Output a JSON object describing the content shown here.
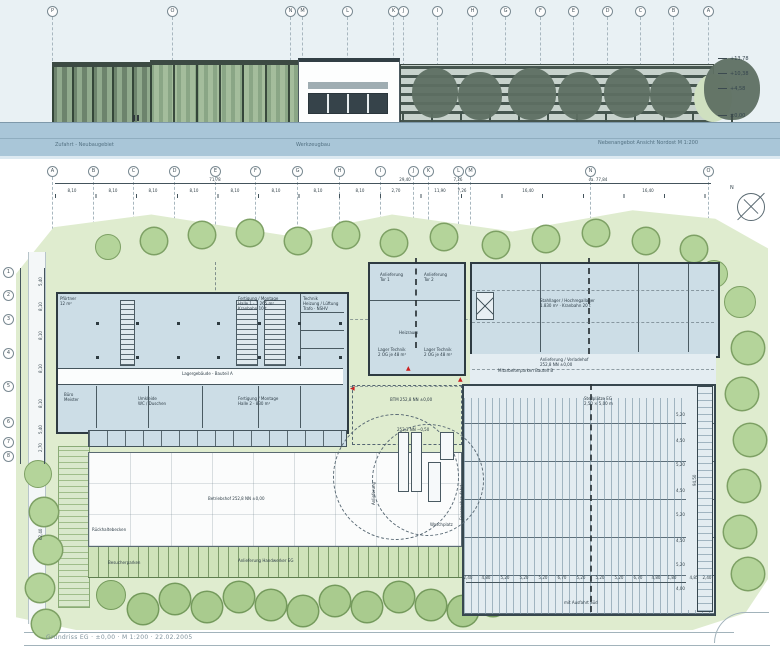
{
  "title_block": {
    "text": "Grundriss EG · ±0,00 · M 1:200 · 22.02.2005"
  },
  "colors": {
    "sky": "#e9f1f4",
    "ground_blue": "#a9c6d8",
    "site_green": "#dfeccf",
    "tree_green": "#b4d49a",
    "building_fill": "#ccdde6",
    "wall": "#2e3b42",
    "red_accent": "#cc2020"
  },
  "elevation": {
    "labels": {
      "left": "Zufahrt - Neubaugebiet",
      "mid": "Werkzeugbau",
      "right": "Nebenangebot Ansicht Nordost M 1:200"
    },
    "levels": [
      {
        "label": "+13,78",
        "x": 718,
        "y": 56
      },
      {
        "label": "+10,38",
        "x": 718,
        "y": 71
      },
      {
        "label": "+4,58",
        "x": 718,
        "y": 86
      },
      {
        "label": "±0,00",
        "x": 718,
        "y": 113
      }
    ],
    "grid_markers": [
      {
        "label": "P",
        "x": 52
      },
      {
        "label": "O",
        "x": 172
      },
      {
        "label": "N",
        "x": 290
      },
      {
        "label": "M",
        "x": 302
      },
      {
        "label": "L",
        "x": 347
      },
      {
        "label": "K",
        "x": 393
      },
      {
        "label": "J",
        "x": 403
      },
      {
        "label": "I",
        "x": 437
      },
      {
        "label": "H",
        "x": 472
      },
      {
        "label": "G",
        "x": 505
      },
      {
        "label": "F",
        "x": 540
      },
      {
        "label": "E",
        "x": 573
      },
      {
        "label": "D",
        "x": 607
      },
      {
        "label": "C",
        "x": 640
      },
      {
        "label": "B",
        "x": 673
      },
      {
        "label": "A",
        "x": 708
      }
    ]
  },
  "plan": {
    "north_label": "N",
    "grid_top": [
      {
        "label": "A",
        "x": 52
      },
      {
        "label": "B",
        "x": 93
      },
      {
        "label": "C",
        "x": 133
      },
      {
        "label": "D",
        "x": 174
      },
      {
        "label": "E",
        "x": 215
      },
      {
        "label": "F",
        "x": 255
      },
      {
        "label": "G",
        "x": 297
      },
      {
        "label": "H",
        "x": 339
      },
      {
        "label": "I",
        "x": 380
      },
      {
        "label": "J",
        "x": 413
      },
      {
        "label": "K",
        "x": 428
      },
      {
        "label": "L",
        "x": 458
      },
      {
        "label": "M",
        "x": 470
      },
      {
        "label": "N",
        "x": 590
      },
      {
        "label": "O",
        "x": 708
      }
    ],
    "grid_left": [
      {
        "label": "1",
        "y": 272
      },
      {
        "label": "2",
        "y": 295
      },
      {
        "label": "3",
        "y": 319
      },
      {
        "label": "4",
        "y": 353
      },
      {
        "label": "5",
        "y": 386
      },
      {
        "label": "6",
        "y": 422
      },
      {
        "label": "7",
        "y": 442
      },
      {
        "label": "8",
        "y": 456
      }
    ],
    "dim_top_upper": [
      {
        "label": "71,78",
        "x": 215
      },
      {
        "label": "29,40",
        "x": 405
      },
      {
        "label": "7,26",
        "x": 458
      },
      {
        "label": "ca. 77,84",
        "x": 598
      }
    ],
    "dim_top_lower": [
      {
        "label": "8,10",
        "x": 72
      },
      {
        "label": "8,10",
        "x": 113
      },
      {
        "label": "8,10",
        "x": 153
      },
      {
        "label": "8,10",
        "x": 194
      },
      {
        "label": "8,10",
        "x": 235
      },
      {
        "label": "8,10",
        "x": 276
      },
      {
        "label": "8,10",
        "x": 318
      },
      {
        "label": "8,10",
        "x": 360
      },
      {
        "label": "2,70",
        "x": 396
      },
      {
        "label": "11,90",
        "x": 440
      },
      {
        "label": "7,26",
        "x": 462
      },
      {
        "label": "16,40",
        "x": 528
      },
      {
        "label": "16,40",
        "x": 648
      }
    ],
    "dim_left_chain": [
      {
        "label": "5,40",
        "y": 286
      },
      {
        "label": "8,10",
        "y": 311
      },
      {
        "label": "8,10",
        "y": 340
      },
      {
        "label": "8,10",
        "y": 373
      },
      {
        "label": "8,10",
        "y": 408
      },
      {
        "label": "5,40",
        "y": 434
      },
      {
        "label": "2,70",
        "y": 452
      },
      {
        "label": "62,40",
        "y": 540
      }
    ],
    "dim_parking_bottom": [
      {
        "label": "2,40",
        "x": 468
      },
      {
        "label": "4,80",
        "x": 486
      },
      {
        "label": "5,20",
        "x": 505
      },
      {
        "label": "5,20",
        "x": 524
      },
      {
        "label": "5,20",
        "x": 543
      },
      {
        "label": "6,70",
        "x": 562
      },
      {
        "label": "5,20",
        "x": 581
      },
      {
        "label": "5,20",
        "x": 600
      },
      {
        "label": "5,20",
        "x": 619
      },
      {
        "label": "6,70",
        "x": 638
      },
      {
        "label": "4,80",
        "x": 656
      },
      {
        "label": "1,80",
        "x": 672
      },
      {
        "label": "4,85",
        "x": 694
      },
      {
        "label": "2,40",
        "x": 707
      }
    ],
    "dim_parking_right": [
      {
        "label": "5,20",
        "y": 412
      },
      {
        "label": "4,50",
        "y": 438
      },
      {
        "label": "5,20",
        "y": 462
      },
      {
        "label": "4,50",
        "y": 488
      },
      {
        "label": "5,20",
        "y": 512
      },
      {
        "label": "4,50",
        "y": 538
      },
      {
        "label": "5,20",
        "y": 562
      },
      {
        "label": "4,00",
        "y": 586
      }
    ],
    "dim_parking_total": {
      "label": "94,50",
      "x": 692,
      "y": 486
    },
    "rooms": [
      {
        "text": "Pförtner\n12 m²",
        "x": 60,
        "y": 296
      },
      {
        "text": "Fertigung / Montage\nHalle 1 · 1.265 m²\nKranbahn 10 t",
        "x": 238,
        "y": 296
      },
      {
        "text": "Technik\nHeizung / Lüftung\nTrafo · NSHV",
        "x": 303,
        "y": 296
      },
      {
        "text": "Büro\nMeister",
        "x": 64,
        "y": 392
      },
      {
        "text": "Umkleide\nWC / Duschen",
        "x": 138,
        "y": 396
      },
      {
        "text": "Fertigung / Montage\nHalle 2 · 830 m²",
        "x": 238,
        "y": 396
      },
      {
        "text": "Lagergebäude - Bauteil A",
        "x": 182,
        "y": 371
      },
      {
        "text": "Anlieferung\nTor 1",
        "x": 380,
        "y": 272
      },
      {
        "text": "Anlieferung\nTor 2",
        "x": 424,
        "y": 272
      },
      {
        "text": "Heizraum",
        "x": 399,
        "y": 330
      },
      {
        "text": "Lager Technik\n2 OG je 48 m²",
        "x": 378,
        "y": 347
      },
      {
        "text": "Lager Technik\n2 OG je 48 m²",
        "x": 424,
        "y": 347
      },
      {
        "text": "Stahllager / Hochregallager\n1.830 m² · Kranbahn 20 t",
        "x": 540,
        "y": 298
      },
      {
        "text": "Anlieferung / Verladehof\n252,8 NN ±0,00",
        "x": 540,
        "y": 357
      },
      {
        "text": "Mitarbeiterparken Bauteil B",
        "x": 498,
        "y": 368
      },
      {
        "text": "Stellplätze EG\n2,50 × 5,00 m",
        "x": 584,
        "y": 396
      },
      {
        "text": "Betriebshof 252,8 NN ±0,00",
        "x": 208,
        "y": 496
      },
      {
        "text": "Rückhaltebecken",
        "x": 92,
        "y": 527
      },
      {
        "text": "Anlieferung Handwerker EG",
        "x": 238,
        "y": 558
      },
      {
        "text": "Besucherparken",
        "x": 108,
        "y": 560
      },
      {
        "text": "BTM 252,8 NN ±0,00",
        "x": 390,
        "y": 397
      },
      {
        "text": "252,3 NN −0,50",
        "x": 397,
        "y": 427
      },
      {
        "text": "mit Ausfahrt Süd",
        "x": 564,
        "y": 600
      },
      {
        "text": "Waschplatz",
        "x": 430,
        "y": 522
      },
      {
        "text": "Feuerwehrzufahrt",
        "x": 459,
        "y": 520,
        "rot": true
      },
      {
        "text": "Anlieferung",
        "x": 371,
        "y": 505,
        "rot": true
      }
    ]
  }
}
